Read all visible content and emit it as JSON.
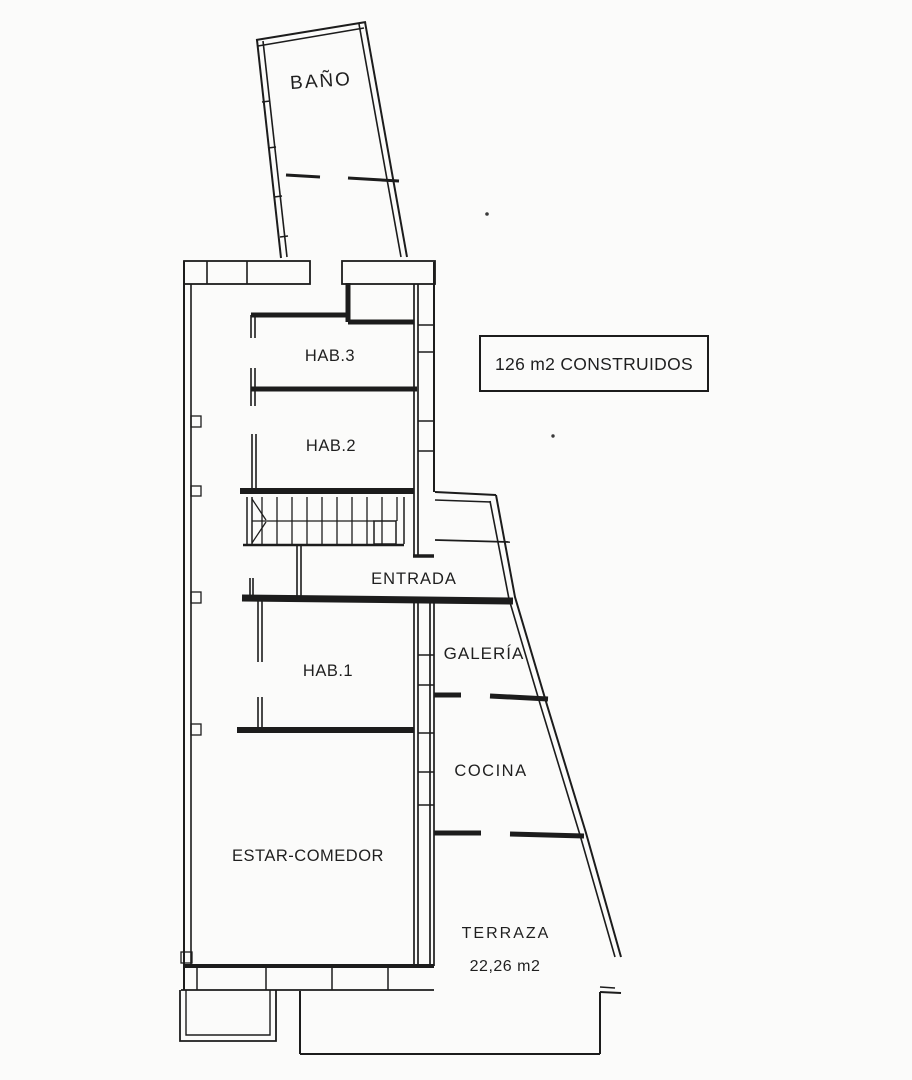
{
  "plan": {
    "info_box": {
      "text": "126 m2 CONSTRUIDOS"
    },
    "rooms": {
      "bano": {
        "label": "BAÑO"
      },
      "hab3": {
        "label": "HAB.3"
      },
      "hab2": {
        "label": "HAB.2"
      },
      "entrada": {
        "label": "ENTRADA"
      },
      "hab1": {
        "label": "HAB.1"
      },
      "galeria": {
        "label": "GALERÍA"
      },
      "cocina": {
        "label": "COCINA"
      },
      "estar": {
        "label": "ESTAR-COMEDOR"
      },
      "terraza": {
        "label": "TERRAZA",
        "area": "22,26 m2"
      }
    },
    "colors": {
      "ink": "#1c1c1c",
      "paper": "#fbfbfa"
    }
  }
}
